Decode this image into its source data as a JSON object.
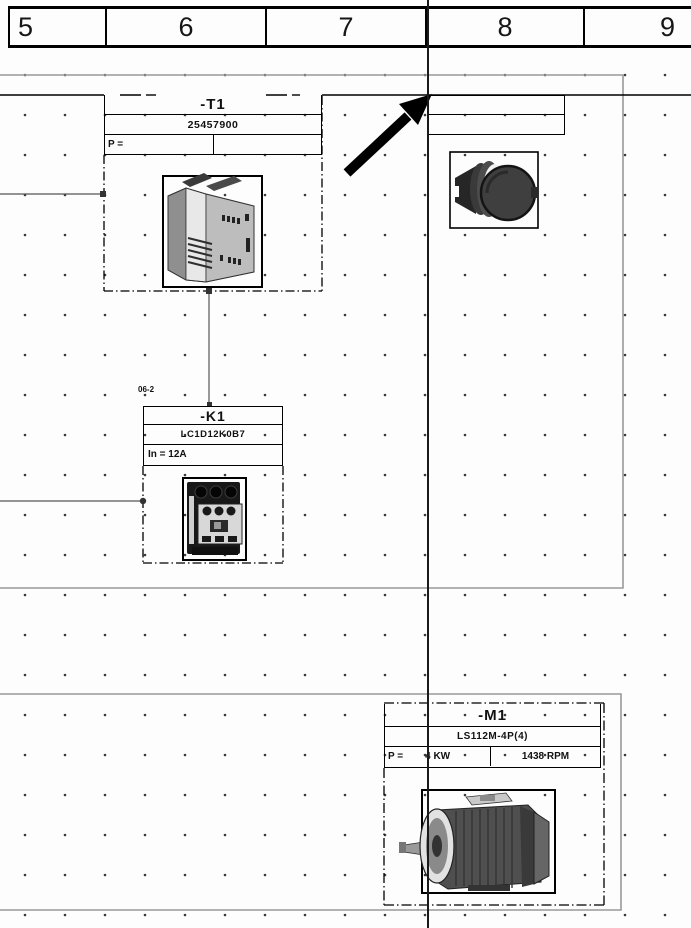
{
  "drawing": {
    "header_columns": [
      "5",
      "6",
      "7",
      "8",
      "9"
    ],
    "groups": {
      "t1": {
        "tag": "-T1",
        "part_number": "25457900",
        "power_label": "P ="
      },
      "pushbutton": {
        "row1": "",
        "row2": ""
      },
      "k1": {
        "cross_ref": "06-2",
        "tag": "-K1",
        "part_number": "LC1D12K0B7",
        "current_text": "In = 12A"
      },
      "m1": {
        "tag": "-M1",
        "part_number": "LS112M-4P(4)",
        "power_label": "P =",
        "power_value": "4 KW",
        "speed": "1438 RPM"
      }
    },
    "icons": {
      "transformer": "transformer-3d-image",
      "contactor": "contactor-3d-image",
      "pushbutton": "pushbutton-3d-image",
      "motor": "motor-3d-image",
      "arrow": "northeast-arrow-icon"
    },
    "colors": {
      "line": "#000000",
      "zone_border": "#999999",
      "grid_dot": "#3a3a3a",
      "background": "#ffffff"
    }
  }
}
